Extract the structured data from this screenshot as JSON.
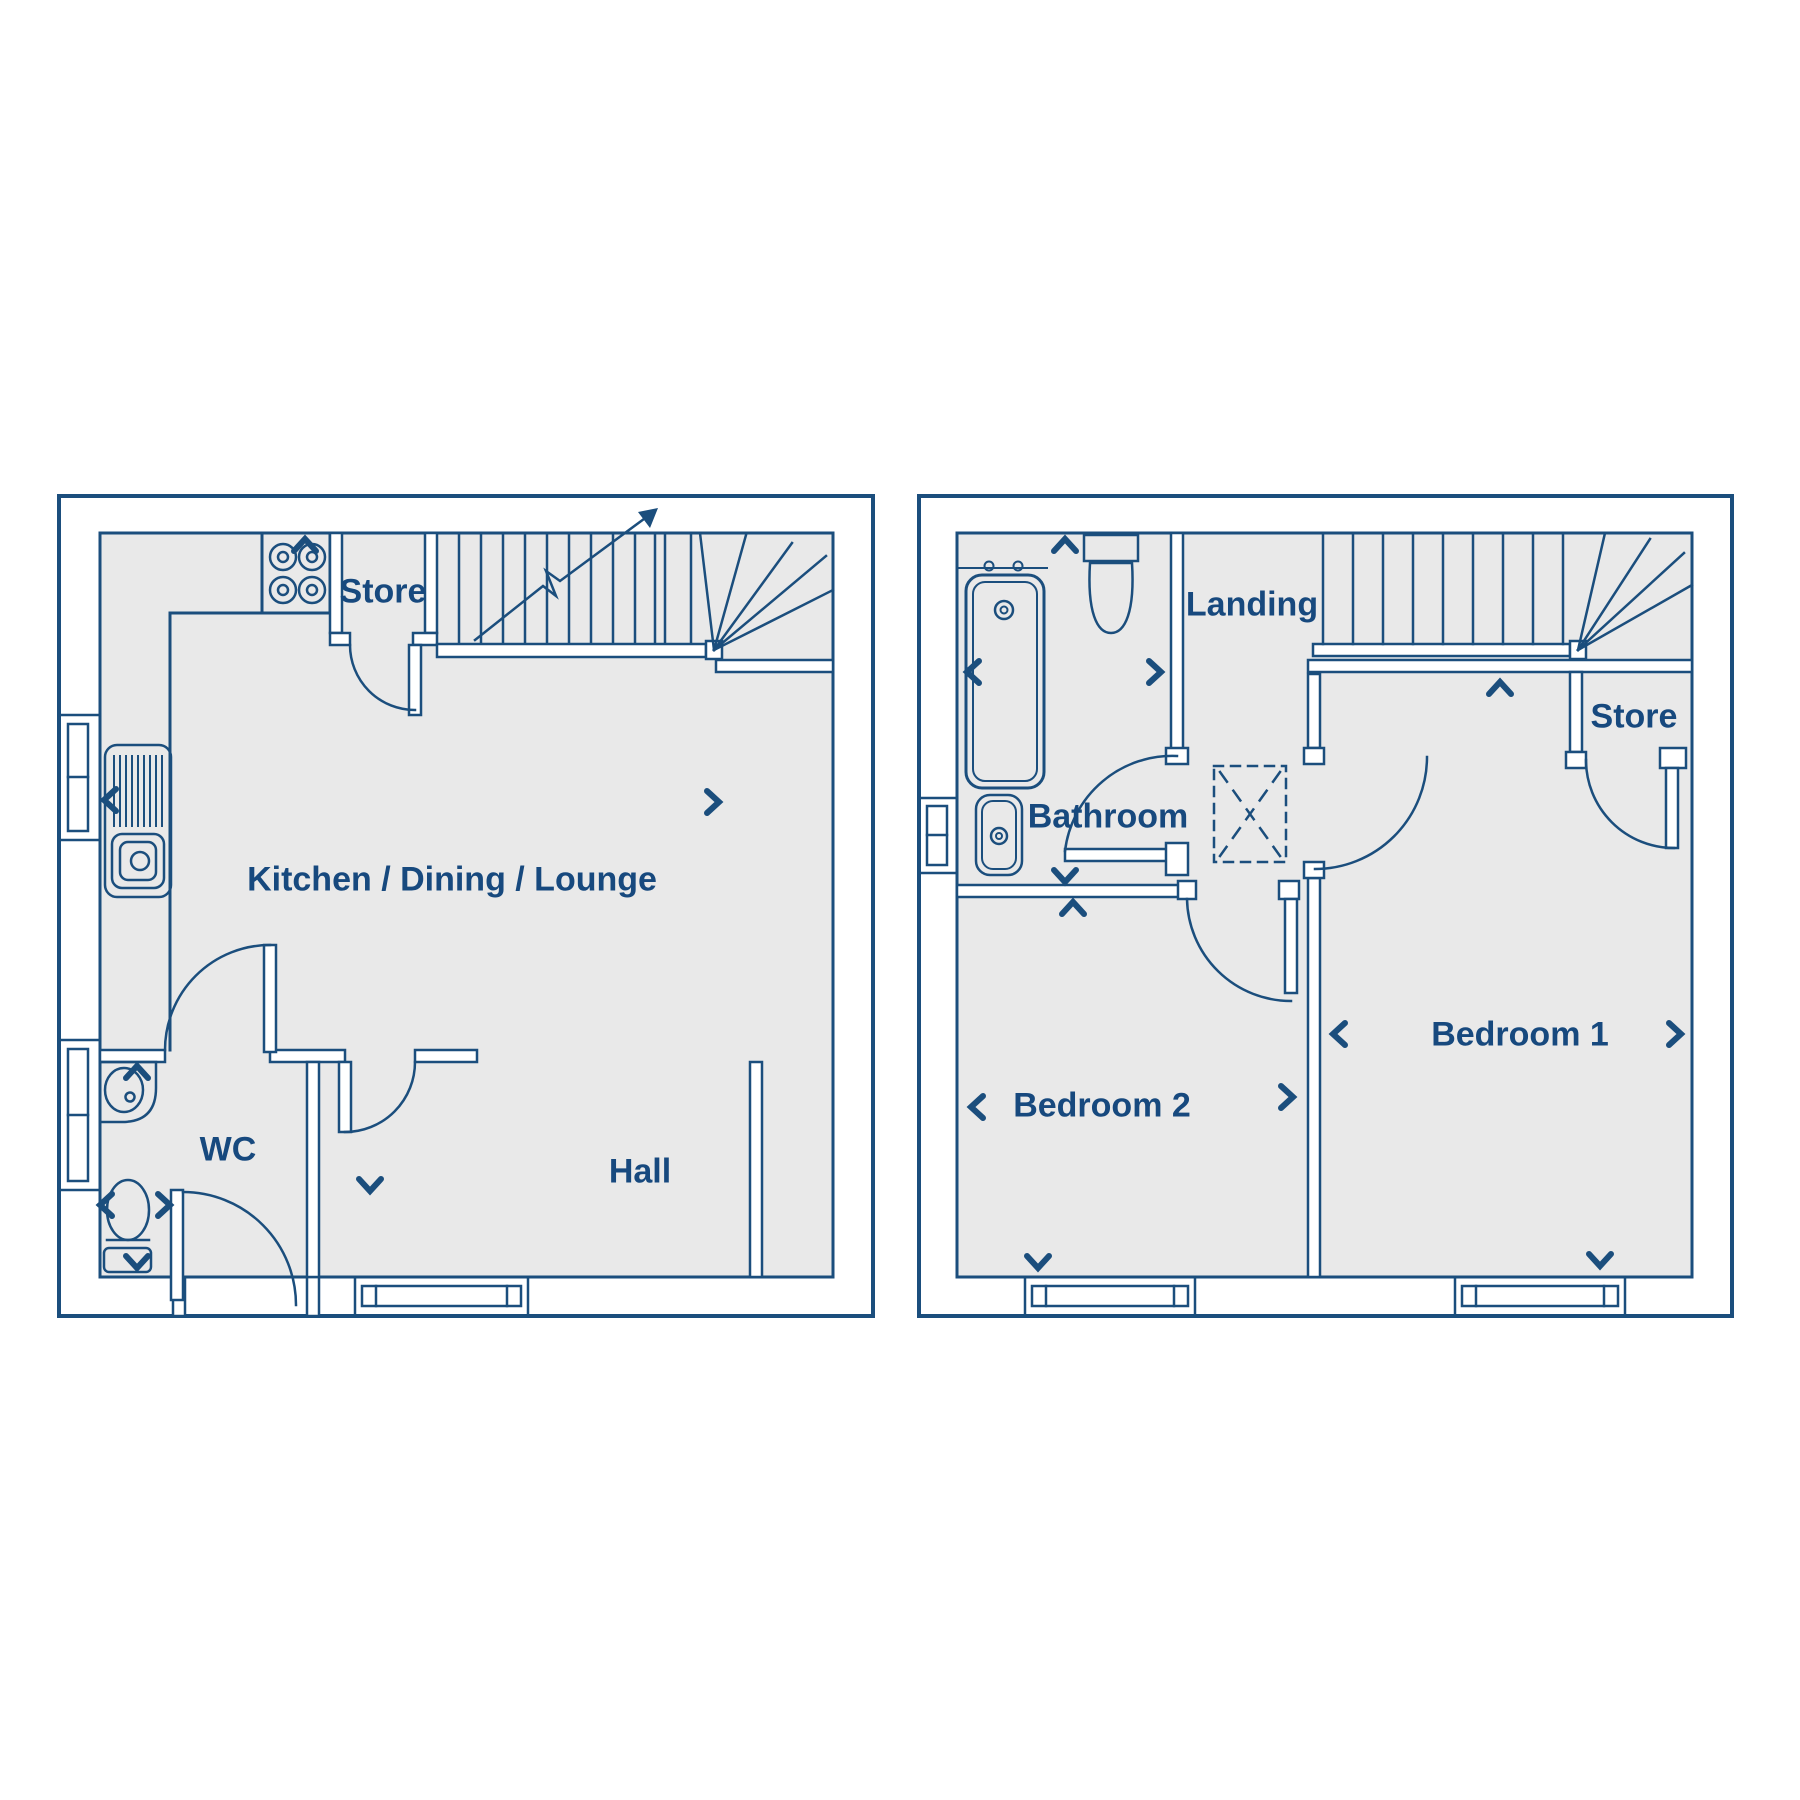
{
  "colors": {
    "line": "#1b4e7d",
    "floor_fill": "#e9e9e9",
    "background": "#ffffff",
    "text": "#17497e"
  },
  "floorplan": {
    "ground_floor": {
      "rooms": [
        {
          "label": "Store"
        },
        {
          "label": "Kitchen / Dining / Lounge"
        },
        {
          "label": "WC"
        },
        {
          "label": "Hall"
        }
      ]
    },
    "first_floor": {
      "rooms": [
        {
          "label": "Bathroom"
        },
        {
          "label": "Landing"
        },
        {
          "label": "Store"
        },
        {
          "label": "Bedroom 2"
        },
        {
          "label": "Bedroom 1"
        }
      ]
    }
  }
}
